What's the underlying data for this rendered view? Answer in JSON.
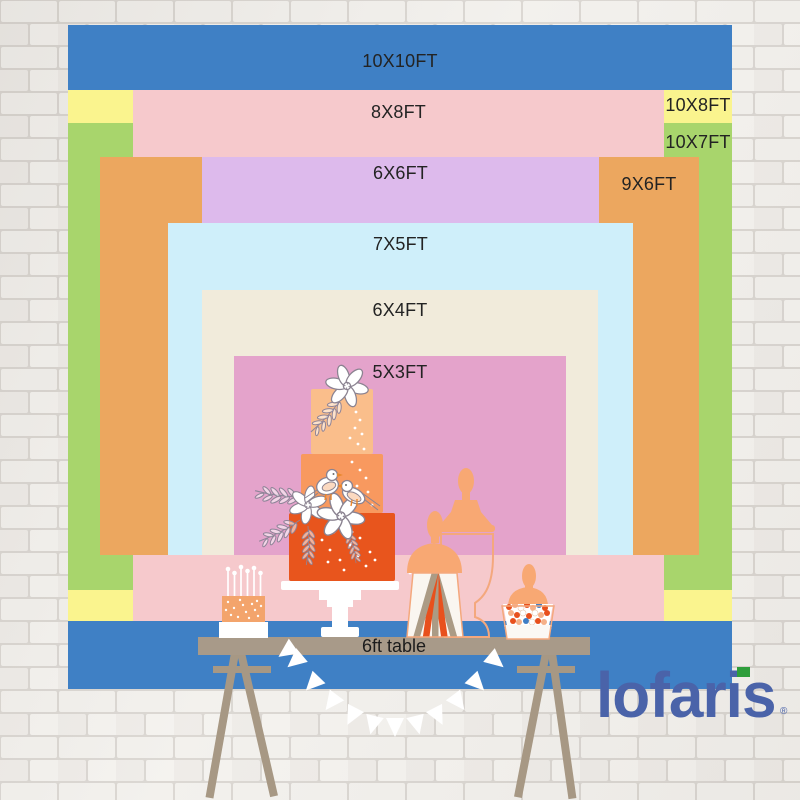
{
  "page": {
    "type": "backdrop size comparison chart",
    "wall": "white painted brick"
  },
  "size_chart": {
    "layers": [
      {
        "label": "10X10FT",
        "width_ft": 10,
        "height_ft": 10,
        "color": "#3F80C5"
      },
      {
        "label": "10X8FT",
        "width_ft": 10,
        "height_ft": 8,
        "color": "#FAF48E"
      },
      {
        "label": "10X7FT",
        "width_ft": 10,
        "height_ft": 7,
        "color": "#A8D56C"
      },
      {
        "label": "8X8FT",
        "width_ft": 8,
        "height_ft": 8,
        "color": "#F6C9CC"
      },
      {
        "label": "9X6FT",
        "width_ft": 9,
        "height_ft": 6,
        "color": "#ECA75F"
      },
      {
        "label": "6X6FT",
        "width_ft": 6,
        "height_ft": 6,
        "color": "#DDBAEC"
      },
      {
        "label": "7X5FT",
        "width_ft": 7,
        "height_ft": 5,
        "color": "#CFEFFA"
      },
      {
        "label": "6X4FT",
        "width_ft": 6,
        "height_ft": 4,
        "color": "#F1EBDB"
      },
      {
        "label": "5X3FT",
        "width_ft": 5,
        "height_ft": 3,
        "color": "#E4A3CB"
      }
    ]
  },
  "table": {
    "label": "6ft table",
    "length_ft": 6
  },
  "brand": {
    "name": "lofaris",
    "registered_mark": "®",
    "logo_color": "#4A63A9",
    "i_dot_color": "#2F9E3C"
  }
}
